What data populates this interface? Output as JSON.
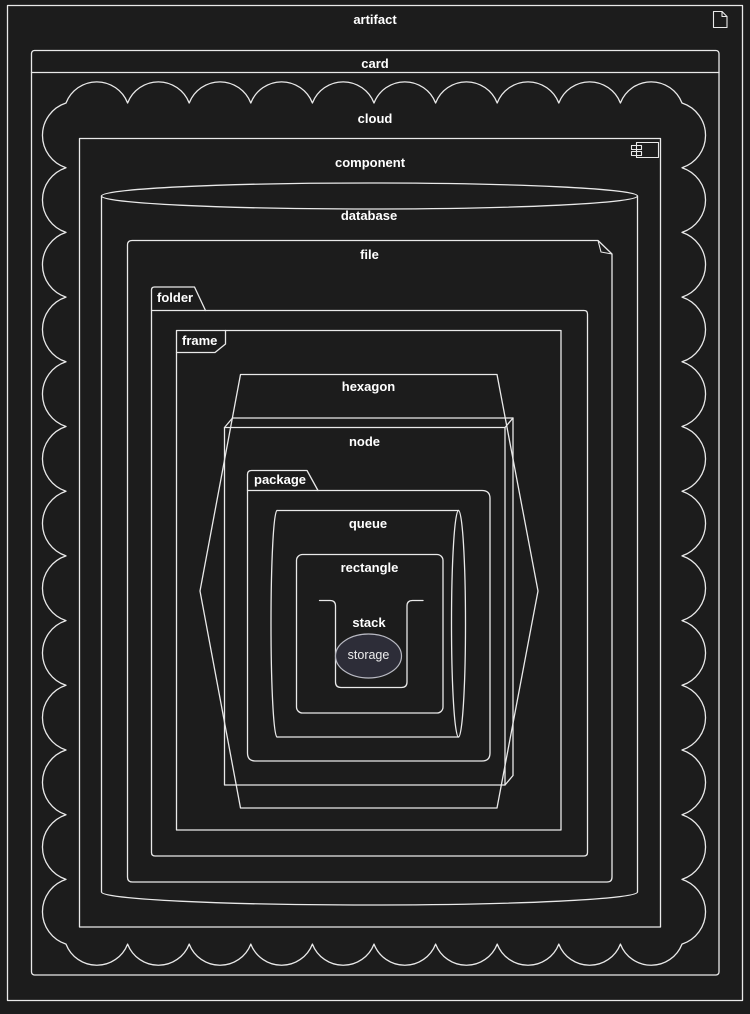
{
  "colors": {
    "background": "#1c1c1c",
    "stroke": "#e9e9e9",
    "text": "#ffffff",
    "storage_fill": "#2d2d38",
    "storage_stroke": "#b9bac3"
  },
  "shapes": {
    "artifact": {
      "label": "artifact"
    },
    "card": {
      "label": "card"
    },
    "cloud": {
      "label": "cloud"
    },
    "component": {
      "label": "component"
    },
    "database": {
      "label": "database"
    },
    "file": {
      "label": "file"
    },
    "folder": {
      "label": "folder"
    },
    "frame": {
      "label": "frame"
    },
    "hexagon": {
      "label": "hexagon"
    },
    "node": {
      "label": "node"
    },
    "package": {
      "label": "package"
    },
    "queue": {
      "label": "queue"
    },
    "rectangle": {
      "label": "rectangle"
    },
    "stack": {
      "label": "stack"
    },
    "storage": {
      "label": "storage"
    }
  }
}
